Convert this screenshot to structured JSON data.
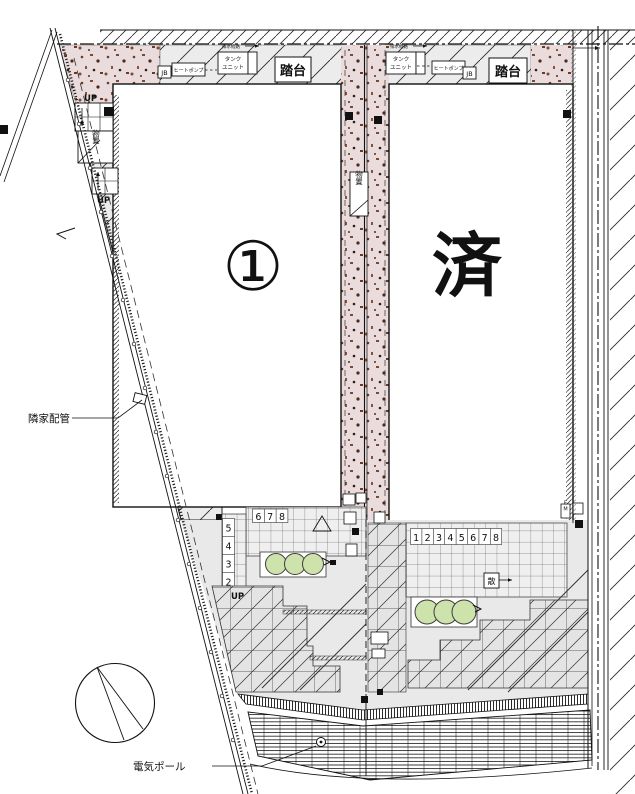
{
  "labels": {
    "unit1": "①",
    "unit2_sold": "済"
  },
  "annotations": {
    "neighbor_piping": "隣家配管",
    "electric_pole": "電気ポール"
  },
  "equipment": {
    "jb": "JB",
    "heat_pump": "ヒートポンプ",
    "tank_line1": "タンク",
    "tank_line2": "ユニット",
    "drain_route": "排水経路",
    "step_platform": "踏台",
    "storage": "物置",
    "sprinkler": "散",
    "meter_em": "EM",
    "up": "UP"
  },
  "step_numbers": {
    "left_top_row": [
      "6",
      "7",
      "8"
    ],
    "left_column": [
      "5",
      "4",
      "3",
      "2",
      "1"
    ],
    "right_row": [
      "1",
      "2",
      "3",
      "4",
      "5",
      "6",
      "7",
      "8"
    ]
  },
  "colors": {
    "sold_red": "#d8321a",
    "up_blue": "#5a5aa8",
    "up_orange": "#c8781e",
    "gravel_pink": "#eadcdc",
    "bush_green": "#cde3ab"
  }
}
